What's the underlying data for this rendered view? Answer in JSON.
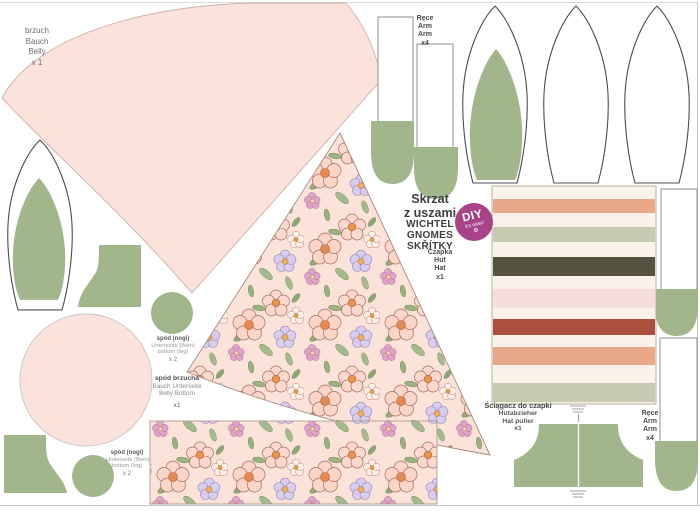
{
  "title": {
    "lines": [
      "Skrzat",
      "z uszami",
      "WICHTEL",
      "GNOMES",
      "SKŘÍTKY"
    ]
  },
  "badge": {
    "title": "DIY",
    "subtitle": "it's easy!",
    "icon": "flower-icon"
  },
  "labels": {
    "belly": {
      "lines": [
        "brzuch",
        "Bauch",
        "Belly",
        "x 1"
      ]
    },
    "arms_top": {
      "lines": [
        "Ręce",
        "Arm",
        "Arm",
        "x4"
      ]
    },
    "hat": {
      "lines": [
        "Czapka",
        "Hut",
        "Hat",
        "x1"
      ]
    },
    "belly_bottom": {
      "lines": [
        "spód brzucha",
        "Bauch Unterseite",
        "Belly Bottom",
        "x1"
      ]
    },
    "feet_1": {
      "lines": [
        "spód (nogi)",
        "Unterseite (Bein)",
        "bottom (leg)",
        "x 2"
      ]
    },
    "feet_2": {
      "lines": [
        "spód (nogi)",
        "Unterseite (Bein)",
        "bottom (leg)",
        "x 2"
      ]
    },
    "hat_puller": {
      "lines": [
        "Ściągacz do czapki",
        "Hutabzieher",
        "Hat puller",
        "x1"
      ]
    },
    "arms_right": {
      "lines": [
        "Ręce",
        "Arm",
        "Arm",
        "x4"
      ]
    }
  },
  "colors": {
    "piece_pink": "#fbe2db",
    "piece_pink_stroke": "#c9b2a9",
    "piece_green": "#a2b68c",
    "floral_background": "#fbe3da",
    "badge_magenta": "#a84289",
    "label_ink": "#4a4a4a",
    "outline_dark": "#4d4d4d",
    "outline_light": "#8f8f8f"
  },
  "striped_panel": {
    "background": "#fbf3e9",
    "stripes": [
      {
        "color": "#e9a888",
        "top": 199,
        "height": 14
      },
      {
        "color": "#c5cab0",
        "top": 227,
        "height": 15
      },
      {
        "color": "#55523f",
        "top": 257,
        "height": 19
      },
      {
        "color": "#f8dedb",
        "top": 289,
        "height": 19
      },
      {
        "color": "#ac4f3e",
        "top": 319,
        "height": 16
      },
      {
        "color": "#e9a888",
        "top": 347,
        "height": 18
      },
      {
        "color": "#c5cab0",
        "top": 383,
        "height": 19
      }
    ]
  }
}
